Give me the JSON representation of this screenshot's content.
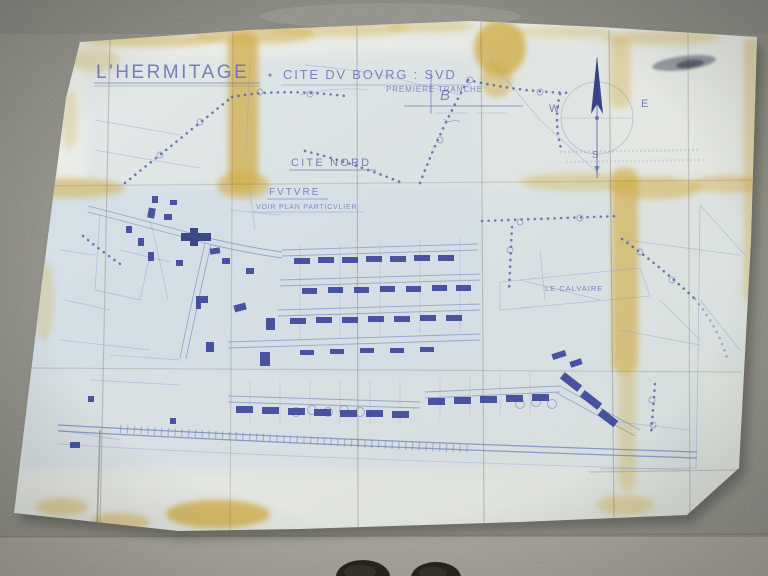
{
  "photo": {
    "surface_colors": {
      "concrete": "#8f8e87",
      "concrete_light_band": "#a7a59b",
      "shoe": "#29241f"
    }
  },
  "map": {
    "title": "L'HERMITAGE",
    "subtitle": "CITE DV BOVRG : SVD",
    "tranche_note": "PREMIERE TRANCHE",
    "scale_mark": "B",
    "compass": {
      "west": "W",
      "east": "E",
      "south": "S"
    },
    "labels": {
      "cite_nord": "CITE NORD",
      "future": "FVTVRE",
      "voir_plan": "VOIR PLAN PARTICVLIER",
      "le_calvaire": "LE CALVAIRE"
    },
    "ink_colors": {
      "dark": "#333f96",
      "mid": "#6377b8",
      "faint": "#8ba0cd"
    },
    "paper_colors": {
      "paper": "#e6e8e3",
      "blue_wash": "#c2d3e6",
      "fold_stain": "#d2ae4a"
    }
  }
}
